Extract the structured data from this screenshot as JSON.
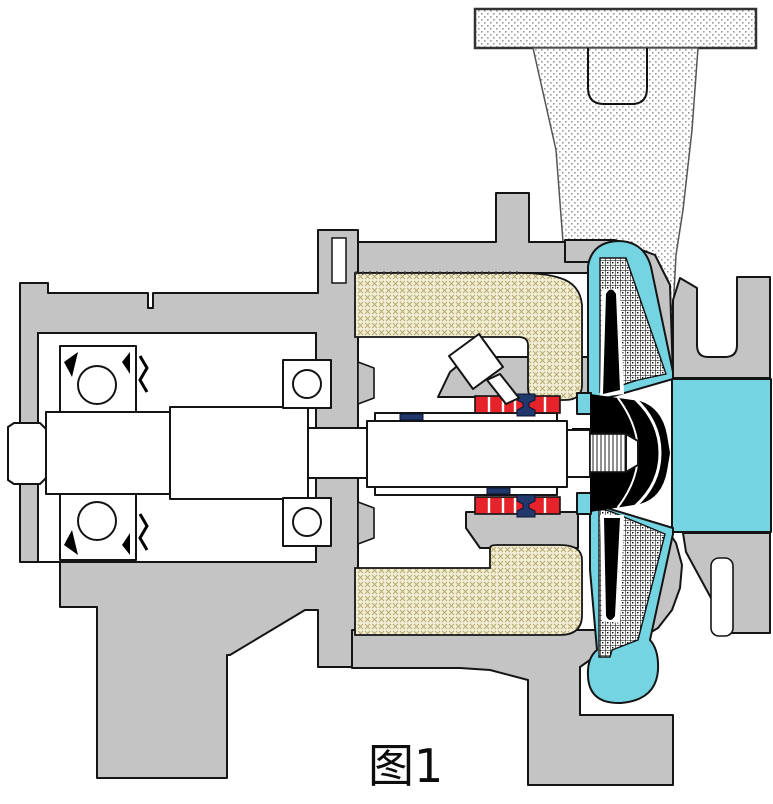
{
  "figure": {
    "caption": "图1",
    "type": "pump-cross-section-diagram"
  },
  "colors": {
    "casing": "#c4c4c4",
    "liquid": "#74d4e2",
    "magnet": "#e6232a",
    "spool": "#20386b",
    "beige_bg": "#f2edd5",
    "beige_hatch": "#b7aa6e",
    "stipple_dot": "#9a9a9a",
    "outline": "#141414",
    "background": "#ffffff"
  },
  "canvas": {
    "width": 773,
    "height": 804
  }
}
